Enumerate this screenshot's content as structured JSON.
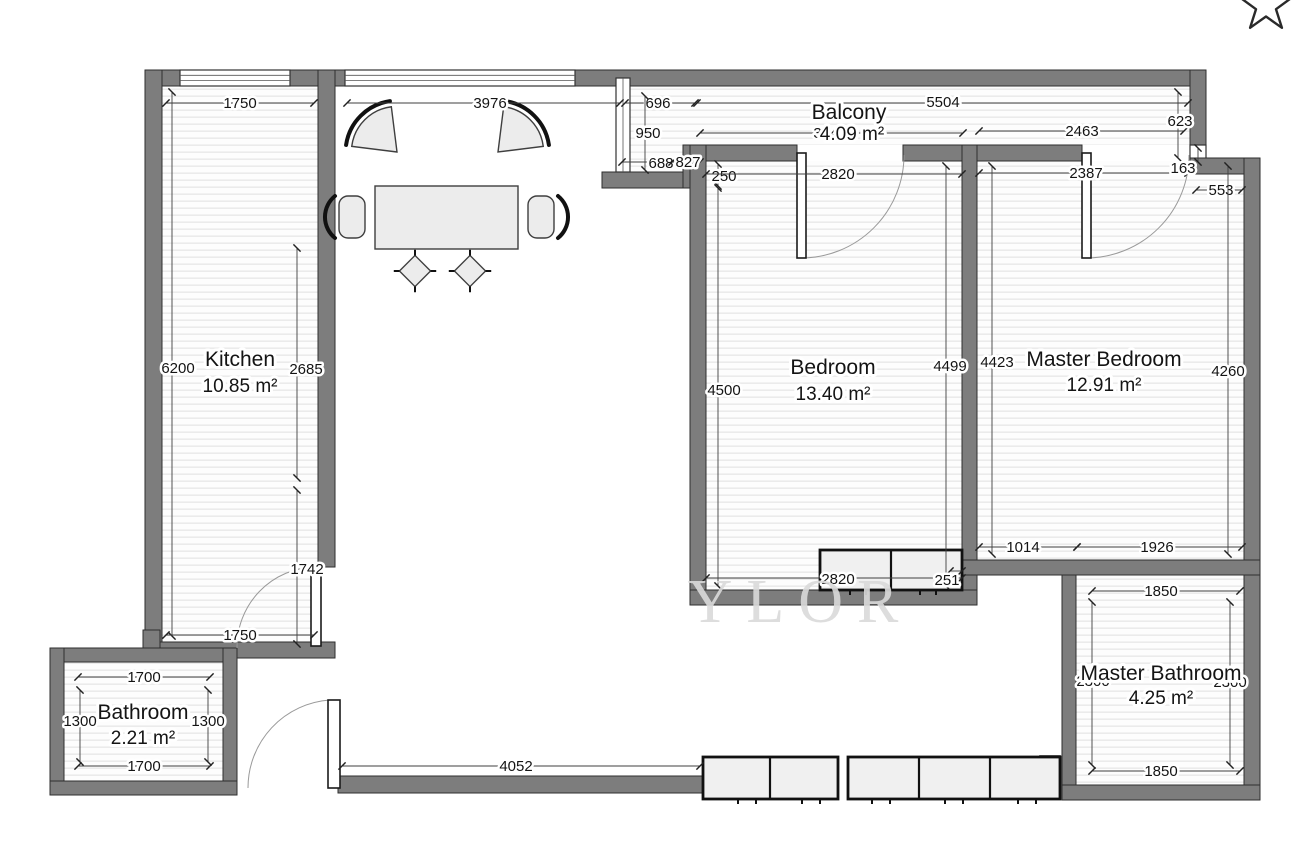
{
  "header": {
    "favorite_icon": "star-outline"
  },
  "watermark": "YLOR",
  "rooms": {
    "kitchen": {
      "name": "Kitchen",
      "area": "10.85 m²"
    },
    "bathroom": {
      "name": "Bathroom",
      "area": "2.21 m²"
    },
    "balcony": {
      "name": "Balcony",
      "area": "4.09 m²"
    },
    "bedroom": {
      "name": "Bedroom",
      "area": "13.40 m²"
    },
    "master_bedroom": {
      "name": "Master Bedroom",
      "area": "12.91 m²"
    },
    "master_bathroom": {
      "name": "Master Bathroom",
      "area": "4.25 m²"
    }
  },
  "dims": {
    "kitchen_top": "1750",
    "living_top": "3976",
    "balcony_696": "696",
    "balcony_total": "5504",
    "balcony_950": "950",
    "balcony_3049": "3049",
    "balcony_2463": "2463",
    "balcony_623": "623",
    "balcony_688": "688",
    "balcony_827": "827",
    "bedroom_250": "250",
    "bedroom_top": "2820",
    "master_top": "2387",
    "notch_163": "163",
    "step_553": "553",
    "kitchen_left": "6200",
    "kitchen_right_upper": "2685",
    "kitchen_right_lower": "1742",
    "kitchen_bottom": "1750",
    "bedroom_left": "4500",
    "bedroom_right": "4499",
    "master_left": "4423",
    "master_right": "4260",
    "bedroom_bottom": "2820",
    "wardrobe_251": "251",
    "master_bottom_left": "1014",
    "master_bottom_right": "1926",
    "mbath_top": "1850",
    "mbath_left": "2300",
    "mbath_right": "2300",
    "mbath_bottom": "1850",
    "bath_top": "1700",
    "bath_left": "1300",
    "bath_right": "1300",
    "bath_bottom": "1700",
    "hall_bottom": "4052"
  },
  "colors": {
    "wall": "#7d7d7d",
    "hatch": "#ebebeb",
    "dimension_text": "#141414",
    "watermark": "#dadada"
  }
}
